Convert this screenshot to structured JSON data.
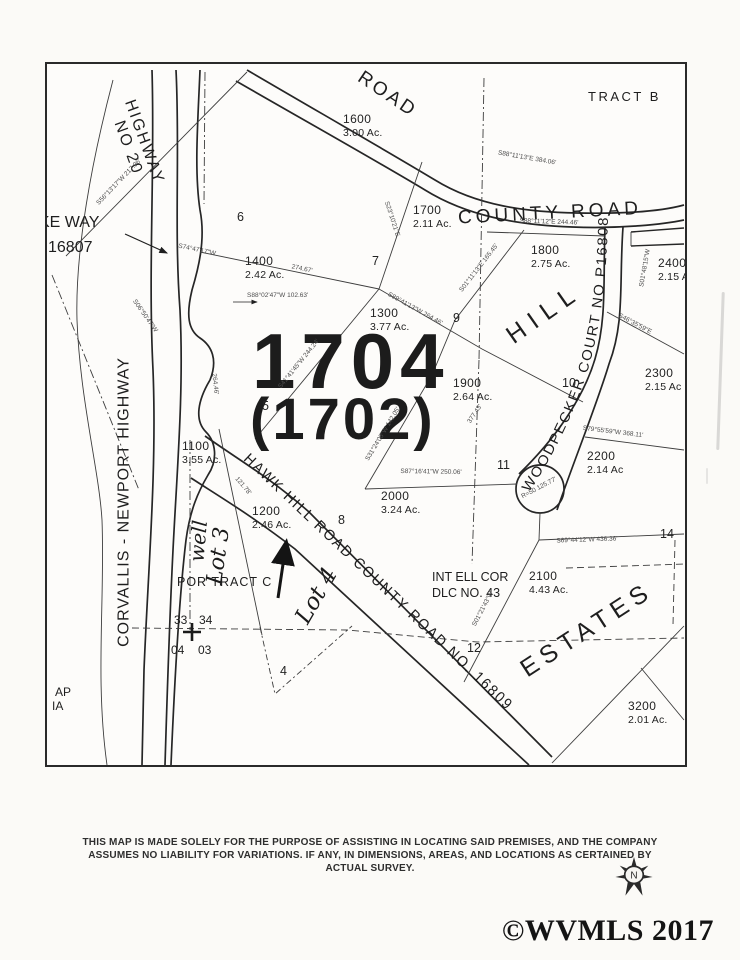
{
  "map": {
    "tax_lot_primary": "1704",
    "tax_lot_secondary": "(1702)",
    "roads": {
      "top_road": "ROAD",
      "county_road": "COUNTY   ROAD",
      "highway_line1": "HIGHWAY",
      "highway_line2": "NO 20",
      "corvallis": "CORVALLIS - NEWPORT  HIGHWAY",
      "hawk_hill": "HAWK  HILL  ROAD   COUNTY  ROAD  NO. 16809",
      "woodpecker": "WOODPECKER  COURT  NO  P16808"
    },
    "area_names": {
      "hill": "HILL",
      "estates": "ESTATES"
    },
    "labels": {
      "tract_b": "TRACT B",
      "ke_way": "KE WAY",
      "plat_16807": "16807",
      "por_tract_c": "POR TRACT C",
      "int_ell_cor": "INT ELL COR",
      "dlc": "DLC NO. 43",
      "ap": "AP",
      "ia": "IA",
      "sec_33": "33",
      "sec_34": "34",
      "sec_04": "04",
      "sec_03": "03"
    },
    "handwritten": {
      "well": "well",
      "lot3": "Lot 3",
      "lot4": "Lot 4"
    },
    "parcels": [
      {
        "number": "1600",
        "acres": "3.00 Ac.",
        "x": 296,
        "y": 48
      },
      {
        "number": "1700",
        "acres": "2.11 Ac.",
        "x": 366,
        "y": 139
      },
      {
        "number": "1800",
        "acres": "2.75 Ac.",
        "x": 484,
        "y": 179
      },
      {
        "number": "2400",
        "acres": "2.15 A",
        "x": 611,
        "y": 192
      },
      {
        "number": "1400",
        "acres": "2.42 Ac.",
        "x": 198,
        "y": 190
      },
      {
        "number": "1300",
        "acres": "3.77 Ac.",
        "x": 323,
        "y": 242
      },
      {
        "number": "1900",
        "acres": "2.64 Ac.",
        "x": 406,
        "y": 312
      },
      {
        "number": "2300",
        "acres": "2.15 Ac",
        "x": 598,
        "y": 302
      },
      {
        "number": "2200",
        "acres": "2.14 Ac",
        "x": 540,
        "y": 385
      },
      {
        "number": "2000",
        "acres": "3.24 Ac.",
        "x": 334,
        "y": 425
      },
      {
        "number": "2100",
        "acres": "4.43 Ac.",
        "x": 482,
        "y": 505
      },
      {
        "number": "1100",
        "acres": "3.55 Ac.",
        "x": 135,
        "y": 375
      },
      {
        "number": "1200",
        "acres": "2.46 Ac.",
        "x": 205,
        "y": 440
      },
      {
        "number": "3200",
        "acres": "2.01 Ac.",
        "x": 581,
        "y": 635
      }
    ],
    "lot_numbers": [
      {
        "n": "6",
        "x": 190,
        "y": 146
      },
      {
        "n": "7",
        "x": 325,
        "y": 190
      },
      {
        "n": "9",
        "x": 406,
        "y": 247
      },
      {
        "n": "10",
        "x": 515,
        "y": 312
      },
      {
        "n": "5",
        "x": 215,
        "y": 335
      },
      {
        "n": "8",
        "x": 291,
        "y": 449
      },
      {
        "n": "11",
        "x": 450,
        "y": 394
      },
      {
        "n": "12",
        "x": 420,
        "y": 577
      },
      {
        "n": "14",
        "x": 613,
        "y": 463
      },
      {
        "n": "4",
        "x": 233,
        "y": 600
      }
    ],
    "survey_annotations": [
      {
        "t": "S74°47'17\"W",
        "x": 150,
        "y": 186,
        "r": 12
      },
      {
        "t": "274.67'",
        "x": 255,
        "y": 205,
        "r": 12
      },
      {
        "t": "S56°13'17\"W  217.96'",
        "x": 72,
        "y": 118,
        "r": -46
      },
      {
        "t": "S23°10'21\"E",
        "x": 345,
        "y": 155,
        "r": 72
      },
      {
        "t": "S89°41'13\"W  264.46'",
        "x": 368,
        "y": 245,
        "r": 29
      },
      {
        "t": "S01°11'13\"E  165.45'",
        "x": 432,
        "y": 204,
        "r": -52
      },
      {
        "t": "S31°24'05\"W  142.05'",
        "x": 336,
        "y": 370,
        "r": -59
      },
      {
        "t": "S87°16'41\"W  250.06'",
        "x": 384,
        "y": 408,
        "r": 1
      },
      {
        "t": "S41°41'45\"W  244.24'",
        "x": 252,
        "y": 300,
        "r": -51
      },
      {
        "t": "S46°35'59\"E",
        "x": 588,
        "y": 260,
        "r": 28
      },
      {
        "t": "S79°55'59\"W  368.11'",
        "x": 566,
        "y": 368,
        "r": 7
      },
      {
        "t": "S69°44'12\"W  436.36'",
        "x": 540,
        "y": 476,
        "r": -2
      },
      {
        "t": "S01°21'43\"W",
        "x": 436,
        "y": 545,
        "r": -62
      },
      {
        "t": "S06°50'47\"W",
        "x": 98,
        "y": 252,
        "r": 55
      },
      {
        "t": "S88°02'47\"W  102.63'",
        "x": 200,
        "y": 228,
        "r": 0
      },
      {
        "t": "S88°11'13\"E  384.06'",
        "x": 480,
        "y": 94,
        "r": 10
      },
      {
        "t": "S88°11'12\"E  244.46'",
        "x": 502,
        "y": 158,
        "r": 2
      },
      {
        "t": "264.46'",
        "x": 168,
        "y": 320,
        "r": 84
      },
      {
        "t": "377.43'",
        "x": 428,
        "y": 350,
        "r": -56
      },
      {
        "t": "121.78'",
        "x": 196,
        "y": 422,
        "r": 50
      },
      {
        "t": "R=50  125.77'",
        "x": 492,
        "y": 424,
        "r": -28
      },
      {
        "t": "S01°48'15\"W",
        "x": 598,
        "y": 204,
        "r": -80
      }
    ]
  },
  "footer": {
    "disclaimer_line1": "THIS MAP IS MADE SOLELY FOR THE PURPOSE OF ASSISTING IN LOCATING SAID PREMISES, AND THE COMPANY",
    "disclaimer_line2": "ASSUMES NO LIABILITY FOR VARIATIONS. IF ANY, IN DIMENSIONS, AREAS, AND LOCATIONS  AS CERTAINED BY",
    "disclaimer_line3": "ACTUAL SURVEY.",
    "copyright": "©WVMLS 2017",
    "compass_letter": "N"
  }
}
